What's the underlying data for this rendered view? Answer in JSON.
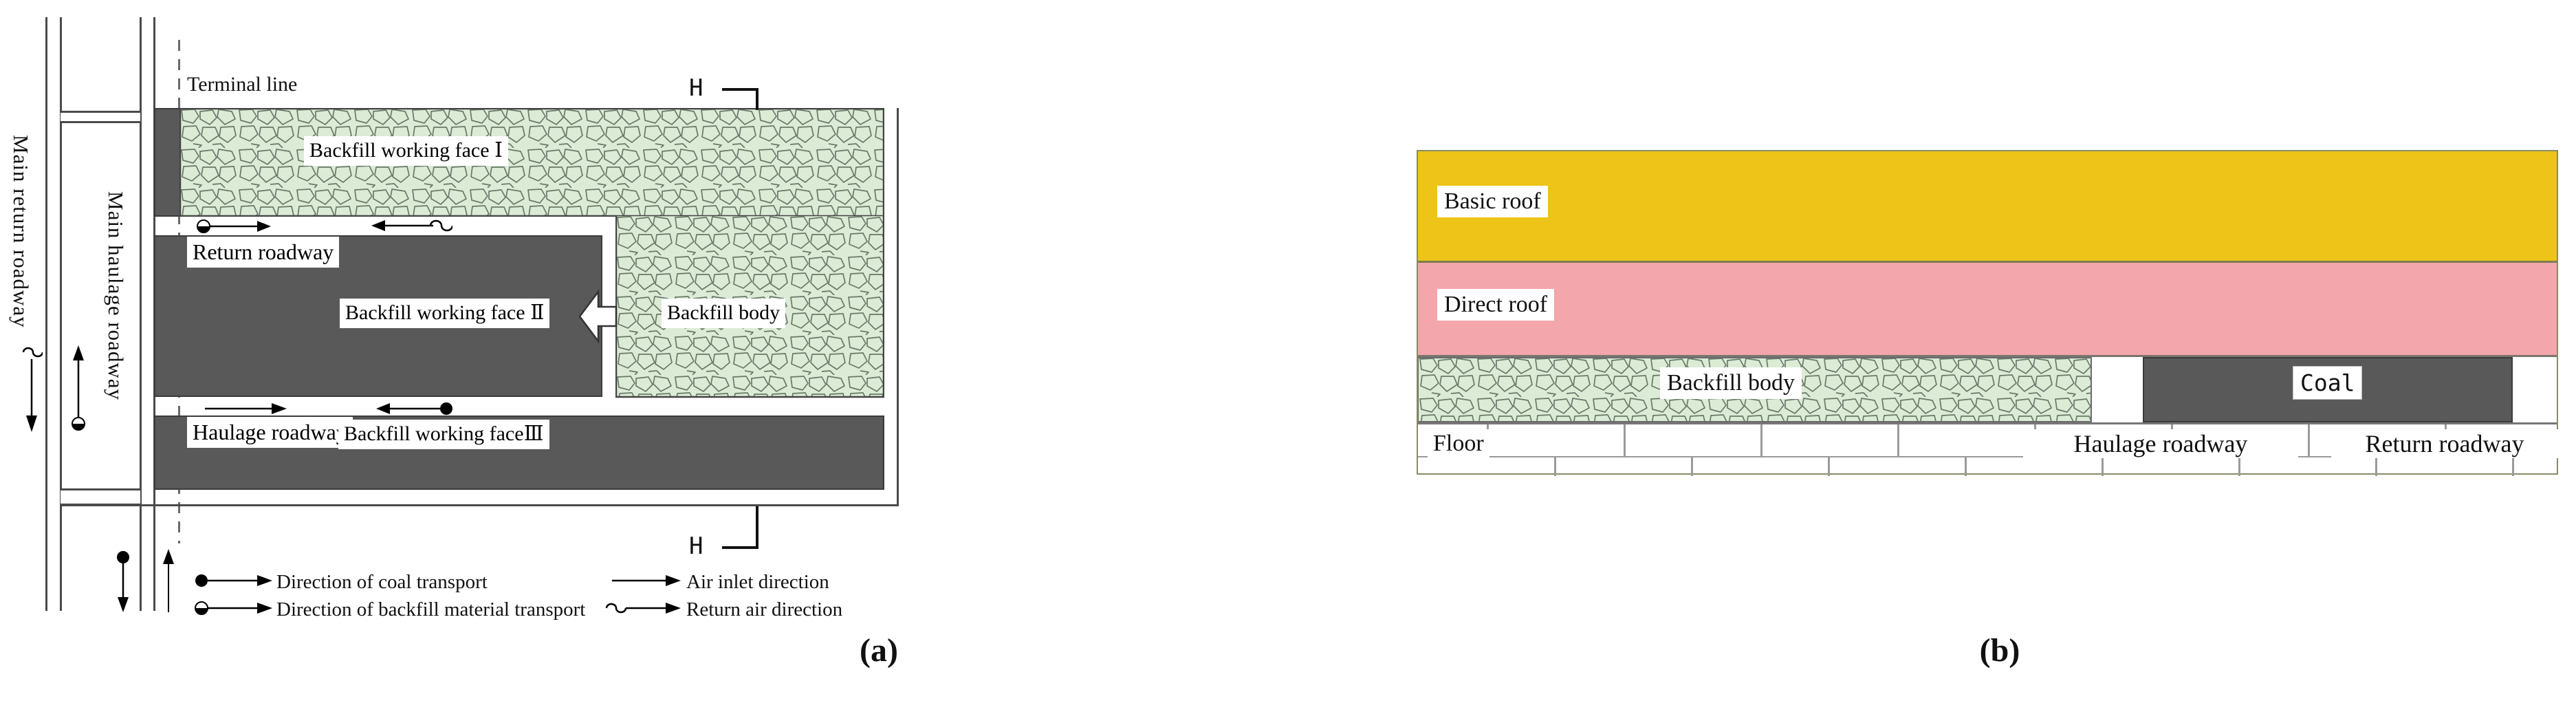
{
  "colors": {
    "c-coal": "#595959",
    "c-yellow": "#edc417",
    "c-pink": "#f3a6ab",
    "c-green": "#dcebd5",
    "c-green-line": "#68796a"
  },
  "panel_a": {
    "caption": "(a)",
    "section_marker": "H",
    "labels": {
      "main_return_roadway": "Main return roadway",
      "main_haulage_roadway": "Main haulage roadway",
      "terminal_line": "Terminal line",
      "backfill_working_face_1": "Backfill working face Ⅰ",
      "backfill_body": "Backfill body",
      "return_roadway": "Return roadway",
      "backfill_working_face_2": "Backfill working face Ⅱ",
      "haulage_roadway": "Haulage roadway",
      "backfill_working_face_3": "Backfill working faceⅢ"
    },
    "legend": [
      {
        "id": "coal-transport",
        "label": "Direction of coal transport"
      },
      {
        "id": "backfill-transport",
        "label": "Direction of backfill material transport"
      },
      {
        "id": "air-inlet",
        "label": "Air inlet direction"
      },
      {
        "id": "return-air",
        "label": "Return air direction"
      }
    ]
  },
  "panel_b": {
    "caption": "(b)",
    "labels": {
      "basic_roof": "Basic roof",
      "direct_roof": "Direct roof",
      "backfill_body": "Backfill body",
      "coal": "Coal",
      "floor": "Floor",
      "haulage_roadway": "Haulage roadway",
      "return_roadway": "Return roadway"
    }
  }
}
